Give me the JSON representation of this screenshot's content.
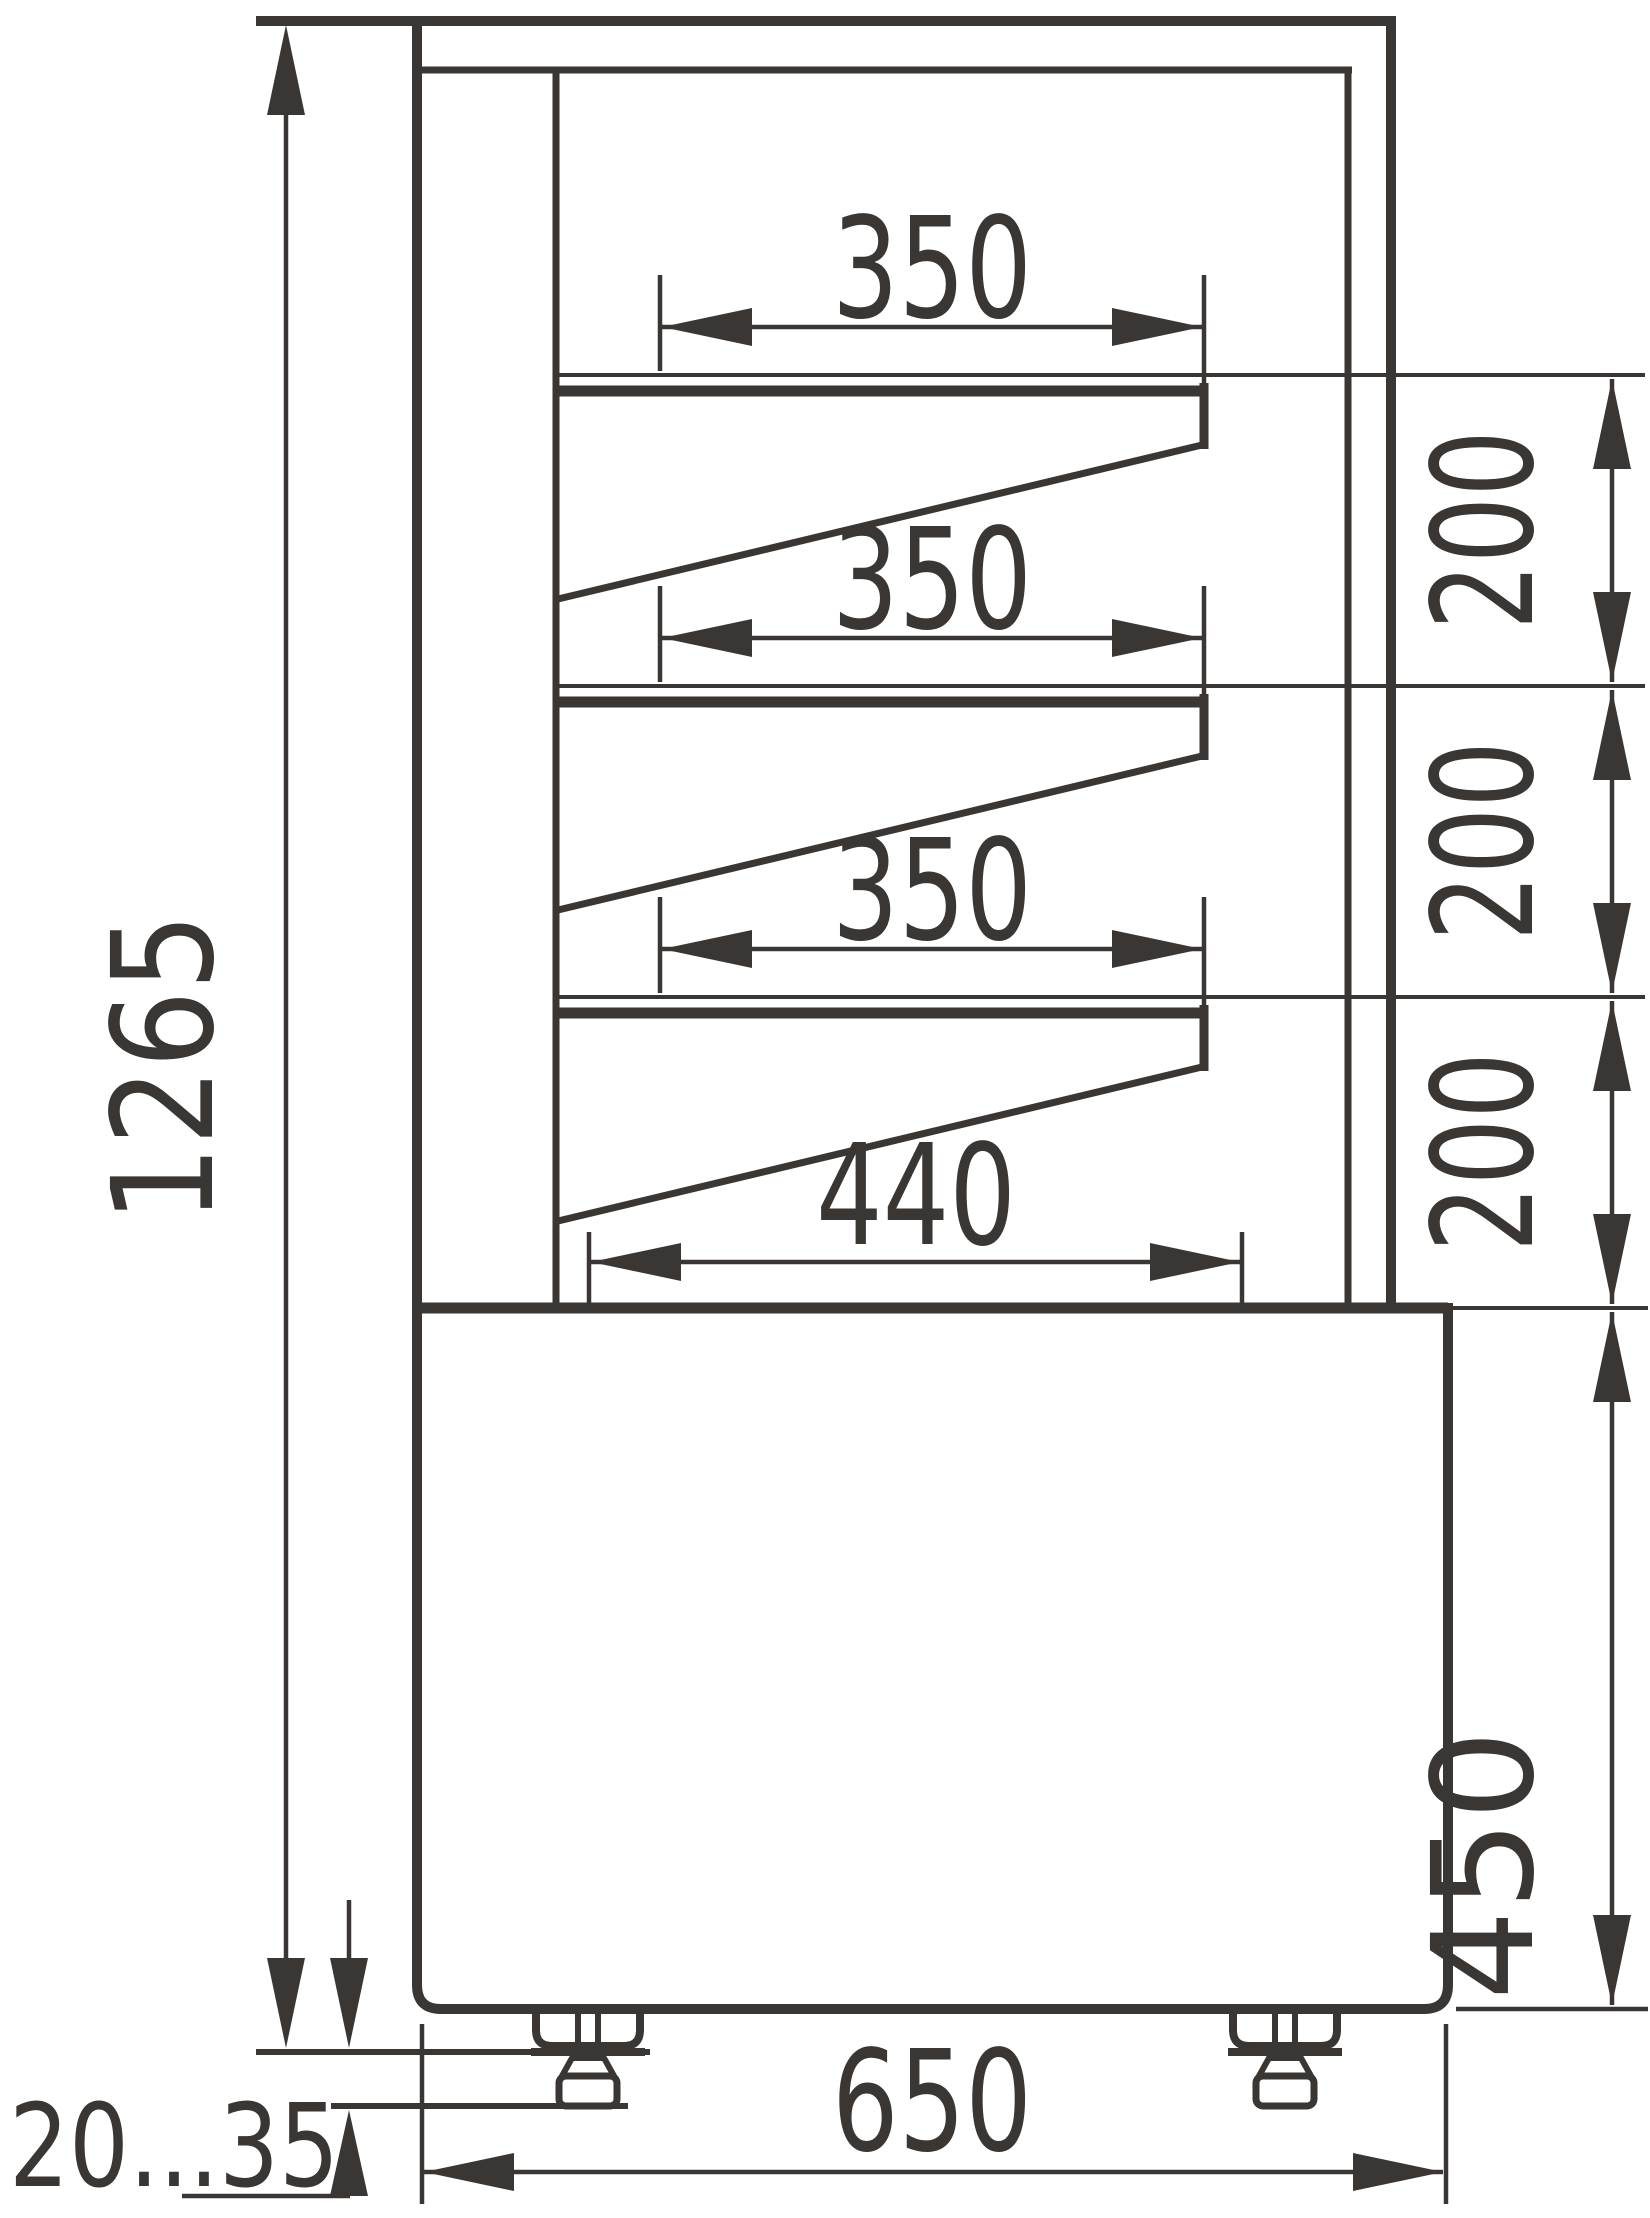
{
  "page": {
    "background": "#ffffff"
  },
  "drawing": {
    "description": "Side-section technical drawing of a refrigerated confectionery display case with three slanted shelves, bottom deck, base cabinet and adjustable feet",
    "line_color": "#3a3633",
    "dims": {
      "overall_height": "1265",
      "shelf_depth_1": "350",
      "shelf_depth_2": "350",
      "shelf_depth_3": "350",
      "bottom_shelf_depth": "440",
      "shelf_gap_1": "200",
      "shelf_gap_2": "200",
      "shelf_gap_3": "200",
      "base_height": "450",
      "overall_depth": "650",
      "foot_adjust_range": "20...35"
    }
  }
}
